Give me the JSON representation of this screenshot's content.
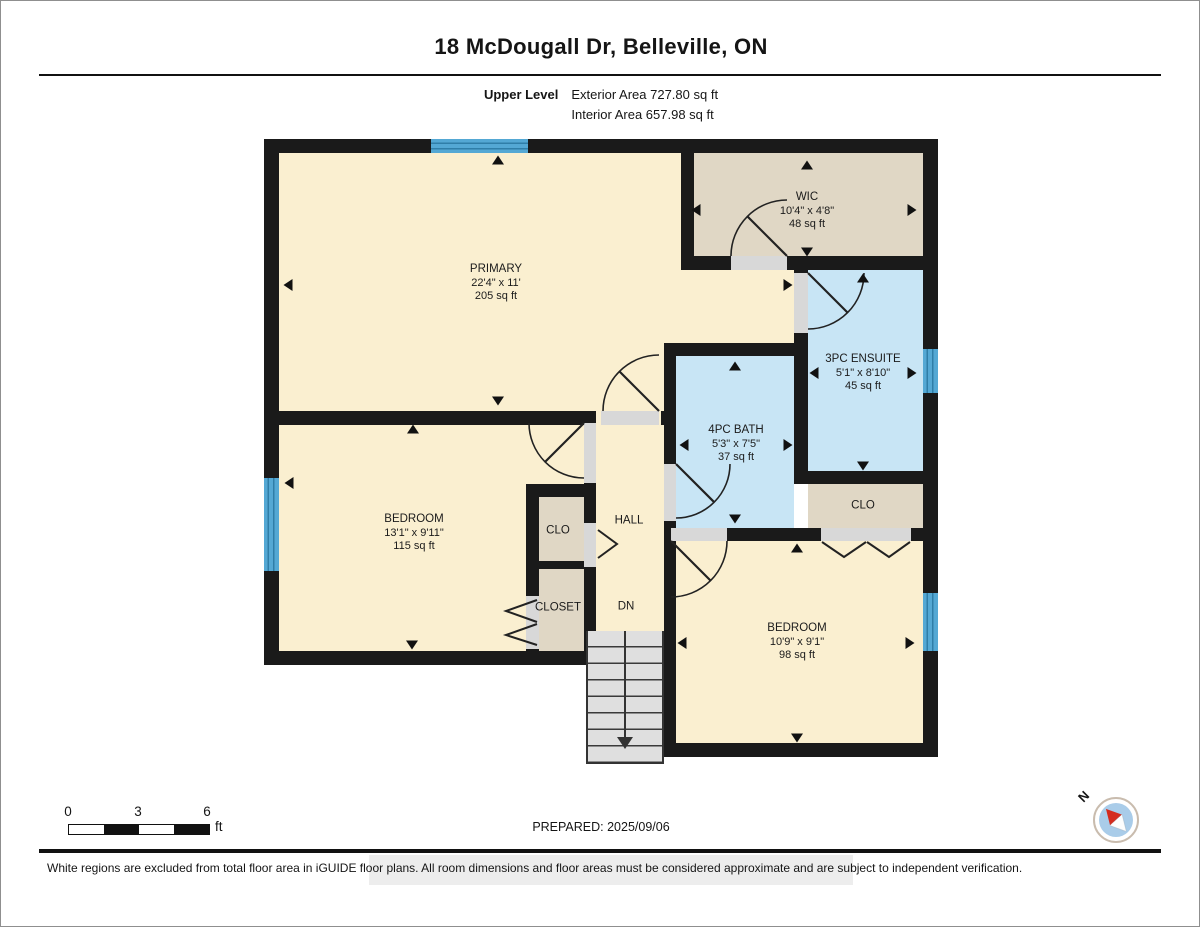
{
  "header": {
    "title": "18 McDougall Dr, Belleville, ON",
    "level_name": "Upper Level",
    "exterior_area": "Exterior Area 727.80 sq ft",
    "interior_area": "Interior Area 657.98 sq ft"
  },
  "rooms": {
    "primary": {
      "name": "PRIMARY",
      "dims": "22'4\" x 11'",
      "area": "205 sq ft"
    },
    "wic": {
      "name": "WIC",
      "dims": "10'4\" x 4'8\"",
      "area": "48 sq ft"
    },
    "ensuite": {
      "name": "3PC ENSUITE",
      "dims": "5'1\" x 8'10\"",
      "area": "45 sq ft"
    },
    "bath": {
      "name": "4PC BATH",
      "dims": "5'3\" x 7'5\"",
      "area": "37 sq ft"
    },
    "clo_ensuite": {
      "name": "CLO"
    },
    "hall": {
      "name": "HALL"
    },
    "stairs": {
      "label": "DN"
    },
    "bedroom_left": {
      "name": "BEDROOM",
      "dims": "13'1\" x 9'11\"",
      "area": "115 sq ft"
    },
    "clo_bedroom": {
      "name": "CLO"
    },
    "closet": {
      "name": "CLOSET"
    },
    "bedroom_right": {
      "name": "BEDROOM",
      "dims": "10'9\" x 9'1\"",
      "area": "98 sq ft"
    }
  },
  "scale_bar": {
    "ticks": [
      "0",
      "3",
      "6"
    ],
    "unit": "ft"
  },
  "compass": {
    "north_label": "N"
  },
  "footer": {
    "prepared": "PREPARED: 2025/09/06",
    "disclaimer": "White regions are excluded from total floor area in iGUIDE floor plans. All room dimensions and floor areas must be considered approximate and are subject to independent verification."
  },
  "colors": {
    "wall": "#1a1a1a",
    "room_cream": "#FAEFD0",
    "closet_tan": "#E0D7C5",
    "bath_blue": "#C8E5F5",
    "window_blue": "#54A8D4",
    "stairs_gray": "#DFDFDF",
    "compass_red": "#D42B1E",
    "compass_blue": "#A9CCE9"
  }
}
